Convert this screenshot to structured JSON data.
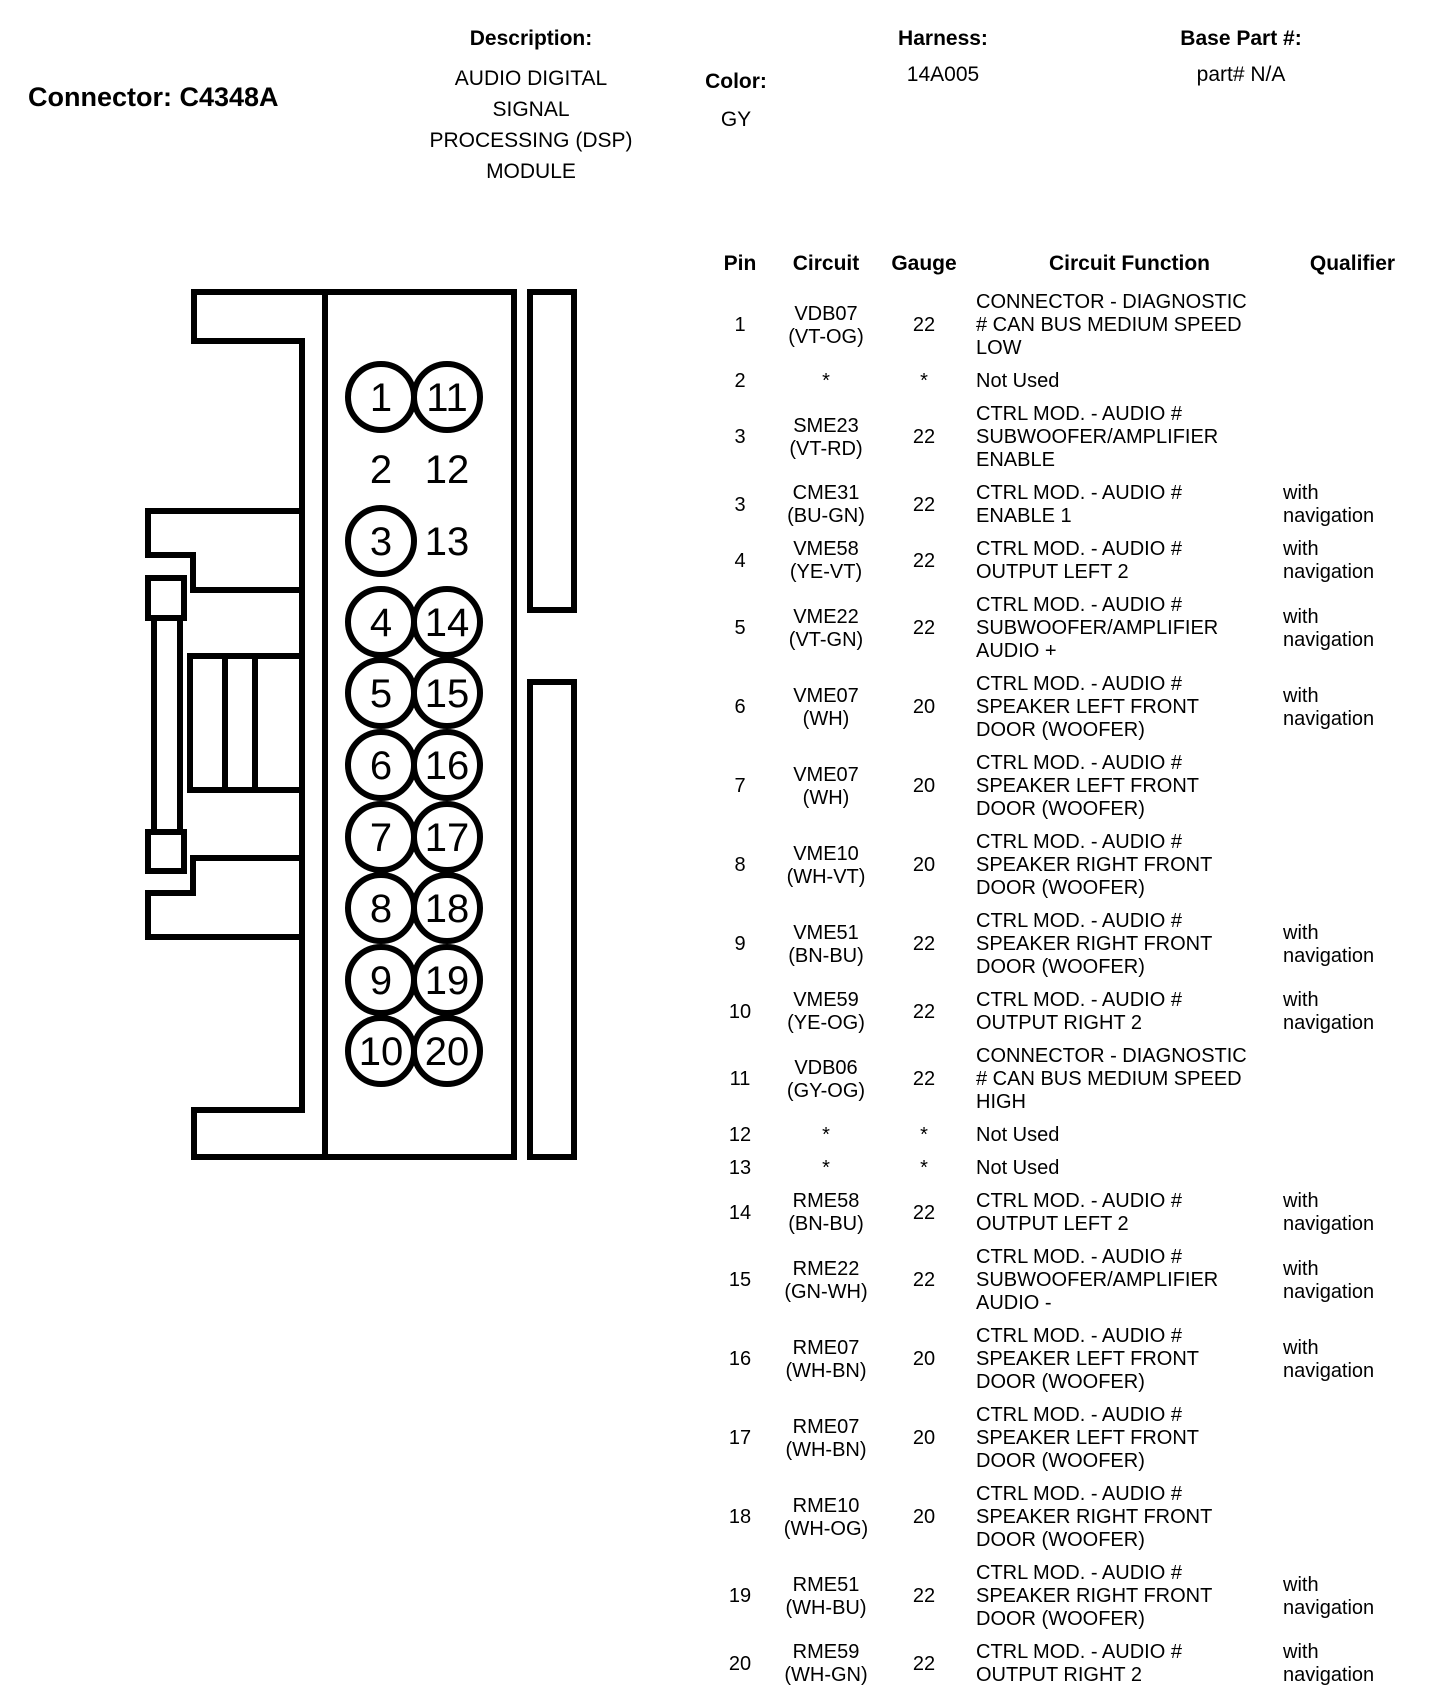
{
  "header": {
    "connector_label": "Connector: C4348A",
    "description_label": "Description:",
    "description_lines": [
      "AUDIO DIGITAL",
      "SIGNAL",
      "PROCESSING (DSP)",
      "MODULE"
    ],
    "color_label": "Color:",
    "color_value": "GY",
    "harness_label": "Harness:",
    "harness_value": "14A005",
    "base_part_label": "Base Part #:",
    "base_part_value": "part# N/A"
  },
  "connector": {
    "id": "C4348A",
    "line_color": "#000000",
    "pins": [
      {
        "label": "1",
        "circled": true
      },
      {
        "label": "2",
        "circled": false
      },
      {
        "label": "3",
        "circled": true
      },
      {
        "label": "4",
        "circled": true
      },
      {
        "label": "5",
        "circled": true
      },
      {
        "label": "6",
        "circled": true
      },
      {
        "label": "7",
        "circled": true
      },
      {
        "label": "8",
        "circled": true
      },
      {
        "label": "9",
        "circled": true
      },
      {
        "label": "10",
        "circled": true
      },
      {
        "label": "11",
        "circled": true
      },
      {
        "label": "12",
        "circled": false
      },
      {
        "label": "13",
        "circled": false
      },
      {
        "label": "14",
        "circled": true
      },
      {
        "label": "15",
        "circled": true
      },
      {
        "label": "16",
        "circled": true
      },
      {
        "label": "17",
        "circled": true
      },
      {
        "label": "18",
        "circled": true
      },
      {
        "label": "19",
        "circled": true
      },
      {
        "label": "20",
        "circled": true
      }
    ]
  },
  "table": {
    "columns": [
      "Pin",
      "Circuit",
      "Gauge",
      "Circuit Function",
      "Qualifier"
    ],
    "rows": [
      {
        "pin": "1",
        "circuit": [
          "VDB07",
          "(VT-OG)"
        ],
        "gauge": "22",
        "function": [
          "CONNECTOR - DIAGNOSTIC",
          "# CAN BUS MEDIUM SPEED",
          "LOW"
        ],
        "qualifier": []
      },
      {
        "pin": "2",
        "circuit": [
          "*"
        ],
        "gauge": "*",
        "function": [
          "Not Used"
        ],
        "qualifier": []
      },
      {
        "pin": "3",
        "circuit": [
          "SME23",
          "(VT-RD)"
        ],
        "gauge": "22",
        "function": [
          "CTRL MOD. - AUDIO #",
          "SUBWOOFER/AMPLIFIER",
          "ENABLE"
        ],
        "qualifier": []
      },
      {
        "pin": "3",
        "circuit": [
          "CME31",
          "(BU-GN)"
        ],
        "gauge": "22",
        "function": [
          "CTRL MOD. - AUDIO #",
          "ENABLE 1"
        ],
        "qualifier": [
          "with",
          "navigation"
        ]
      },
      {
        "pin": "4",
        "circuit": [
          "VME58",
          "(YE-VT)"
        ],
        "gauge": "22",
        "function": [
          "CTRL MOD. - AUDIO #",
          "OUTPUT LEFT 2"
        ],
        "qualifier": [
          "with",
          "navigation"
        ]
      },
      {
        "pin": "5",
        "circuit": [
          "VME22",
          "(VT-GN)"
        ],
        "gauge": "22",
        "function": [
          "CTRL MOD. - AUDIO #",
          "SUBWOOFER/AMPLIFIER",
          "AUDIO +"
        ],
        "qualifier": [
          "with",
          "navigation"
        ]
      },
      {
        "pin": "6",
        "circuit": [
          "VME07",
          "(WH)"
        ],
        "gauge": "20",
        "function": [
          "CTRL MOD. - AUDIO #",
          "SPEAKER LEFT FRONT",
          "DOOR (WOOFER)"
        ],
        "qualifier": [
          "with",
          "navigation"
        ]
      },
      {
        "pin": "7",
        "circuit": [
          "VME07",
          "(WH)"
        ],
        "gauge": "20",
        "function": [
          "CTRL MOD. - AUDIO #",
          "SPEAKER LEFT FRONT",
          "DOOR (WOOFER)"
        ],
        "qualifier": []
      },
      {
        "pin": "8",
        "circuit": [
          "VME10",
          "(WH-VT)"
        ],
        "gauge": "20",
        "function": [
          "CTRL MOD. - AUDIO #",
          "SPEAKER RIGHT FRONT",
          "DOOR (WOOFER)"
        ],
        "qualifier": []
      },
      {
        "pin": "9",
        "circuit": [
          "VME51",
          "(BN-BU)"
        ],
        "gauge": "22",
        "function": [
          "CTRL MOD. - AUDIO #",
          "SPEAKER RIGHT FRONT",
          "DOOR (WOOFER)"
        ],
        "qualifier": [
          "with",
          "navigation"
        ]
      },
      {
        "pin": "10",
        "circuit": [
          "VME59",
          "(YE-OG)"
        ],
        "gauge": "22",
        "function": [
          "CTRL MOD. - AUDIO #",
          "OUTPUT RIGHT 2"
        ],
        "qualifier": [
          "with",
          "navigation"
        ]
      },
      {
        "pin": "11",
        "circuit": [
          "VDB06",
          "(GY-OG)"
        ],
        "gauge": "22",
        "function": [
          "CONNECTOR - DIAGNOSTIC",
          "# CAN BUS MEDIUM SPEED",
          "HIGH"
        ],
        "qualifier": []
      },
      {
        "pin": "12",
        "circuit": [
          "*"
        ],
        "gauge": "*",
        "function": [
          "Not Used"
        ],
        "qualifier": []
      },
      {
        "pin": "13",
        "circuit": [
          "*"
        ],
        "gauge": "*",
        "function": [
          "Not Used"
        ],
        "qualifier": []
      },
      {
        "pin": "14",
        "circuit": [
          "RME58",
          "(BN-BU)"
        ],
        "gauge": "22",
        "function": [
          "CTRL MOD. - AUDIO #",
          "OUTPUT LEFT 2"
        ],
        "qualifier": [
          "with",
          "navigation"
        ]
      },
      {
        "pin": "15",
        "circuit": [
          "RME22",
          "(GN-WH)"
        ],
        "gauge": "22",
        "function": [
          "CTRL MOD. - AUDIO #",
          "SUBWOOFER/AMPLIFIER",
          "AUDIO -"
        ],
        "qualifier": [
          "with",
          "navigation"
        ]
      },
      {
        "pin": "16",
        "circuit": [
          "RME07",
          "(WH-BN)"
        ],
        "gauge": "20",
        "function": [
          "CTRL MOD. - AUDIO #",
          "SPEAKER LEFT FRONT",
          "DOOR (WOOFER)"
        ],
        "qualifier": [
          "with",
          "navigation"
        ]
      },
      {
        "pin": "17",
        "circuit": [
          "RME07",
          "(WH-BN)"
        ],
        "gauge": "20",
        "function": [
          "CTRL MOD. - AUDIO #",
          "SPEAKER LEFT FRONT",
          "DOOR (WOOFER)"
        ],
        "qualifier": []
      },
      {
        "pin": "18",
        "circuit": [
          "RME10",
          "(WH-OG)"
        ],
        "gauge": "20",
        "function": [
          "CTRL MOD. - AUDIO #",
          "SPEAKER RIGHT FRONT",
          "DOOR (WOOFER)"
        ],
        "qualifier": []
      },
      {
        "pin": "19",
        "circuit": [
          "RME51",
          "(WH-BU)"
        ],
        "gauge": "22",
        "function": [
          "CTRL MOD. - AUDIO #",
          "SPEAKER RIGHT FRONT",
          "DOOR (WOOFER)"
        ],
        "qualifier": [
          "with",
          "navigation"
        ]
      },
      {
        "pin": "20",
        "circuit": [
          "RME59",
          "(WH-GN)"
        ],
        "gauge": "22",
        "function": [
          "CTRL MOD. - AUDIO #",
          "OUTPUT RIGHT 2"
        ],
        "qualifier": [
          "with",
          "navigation"
        ]
      }
    ]
  }
}
